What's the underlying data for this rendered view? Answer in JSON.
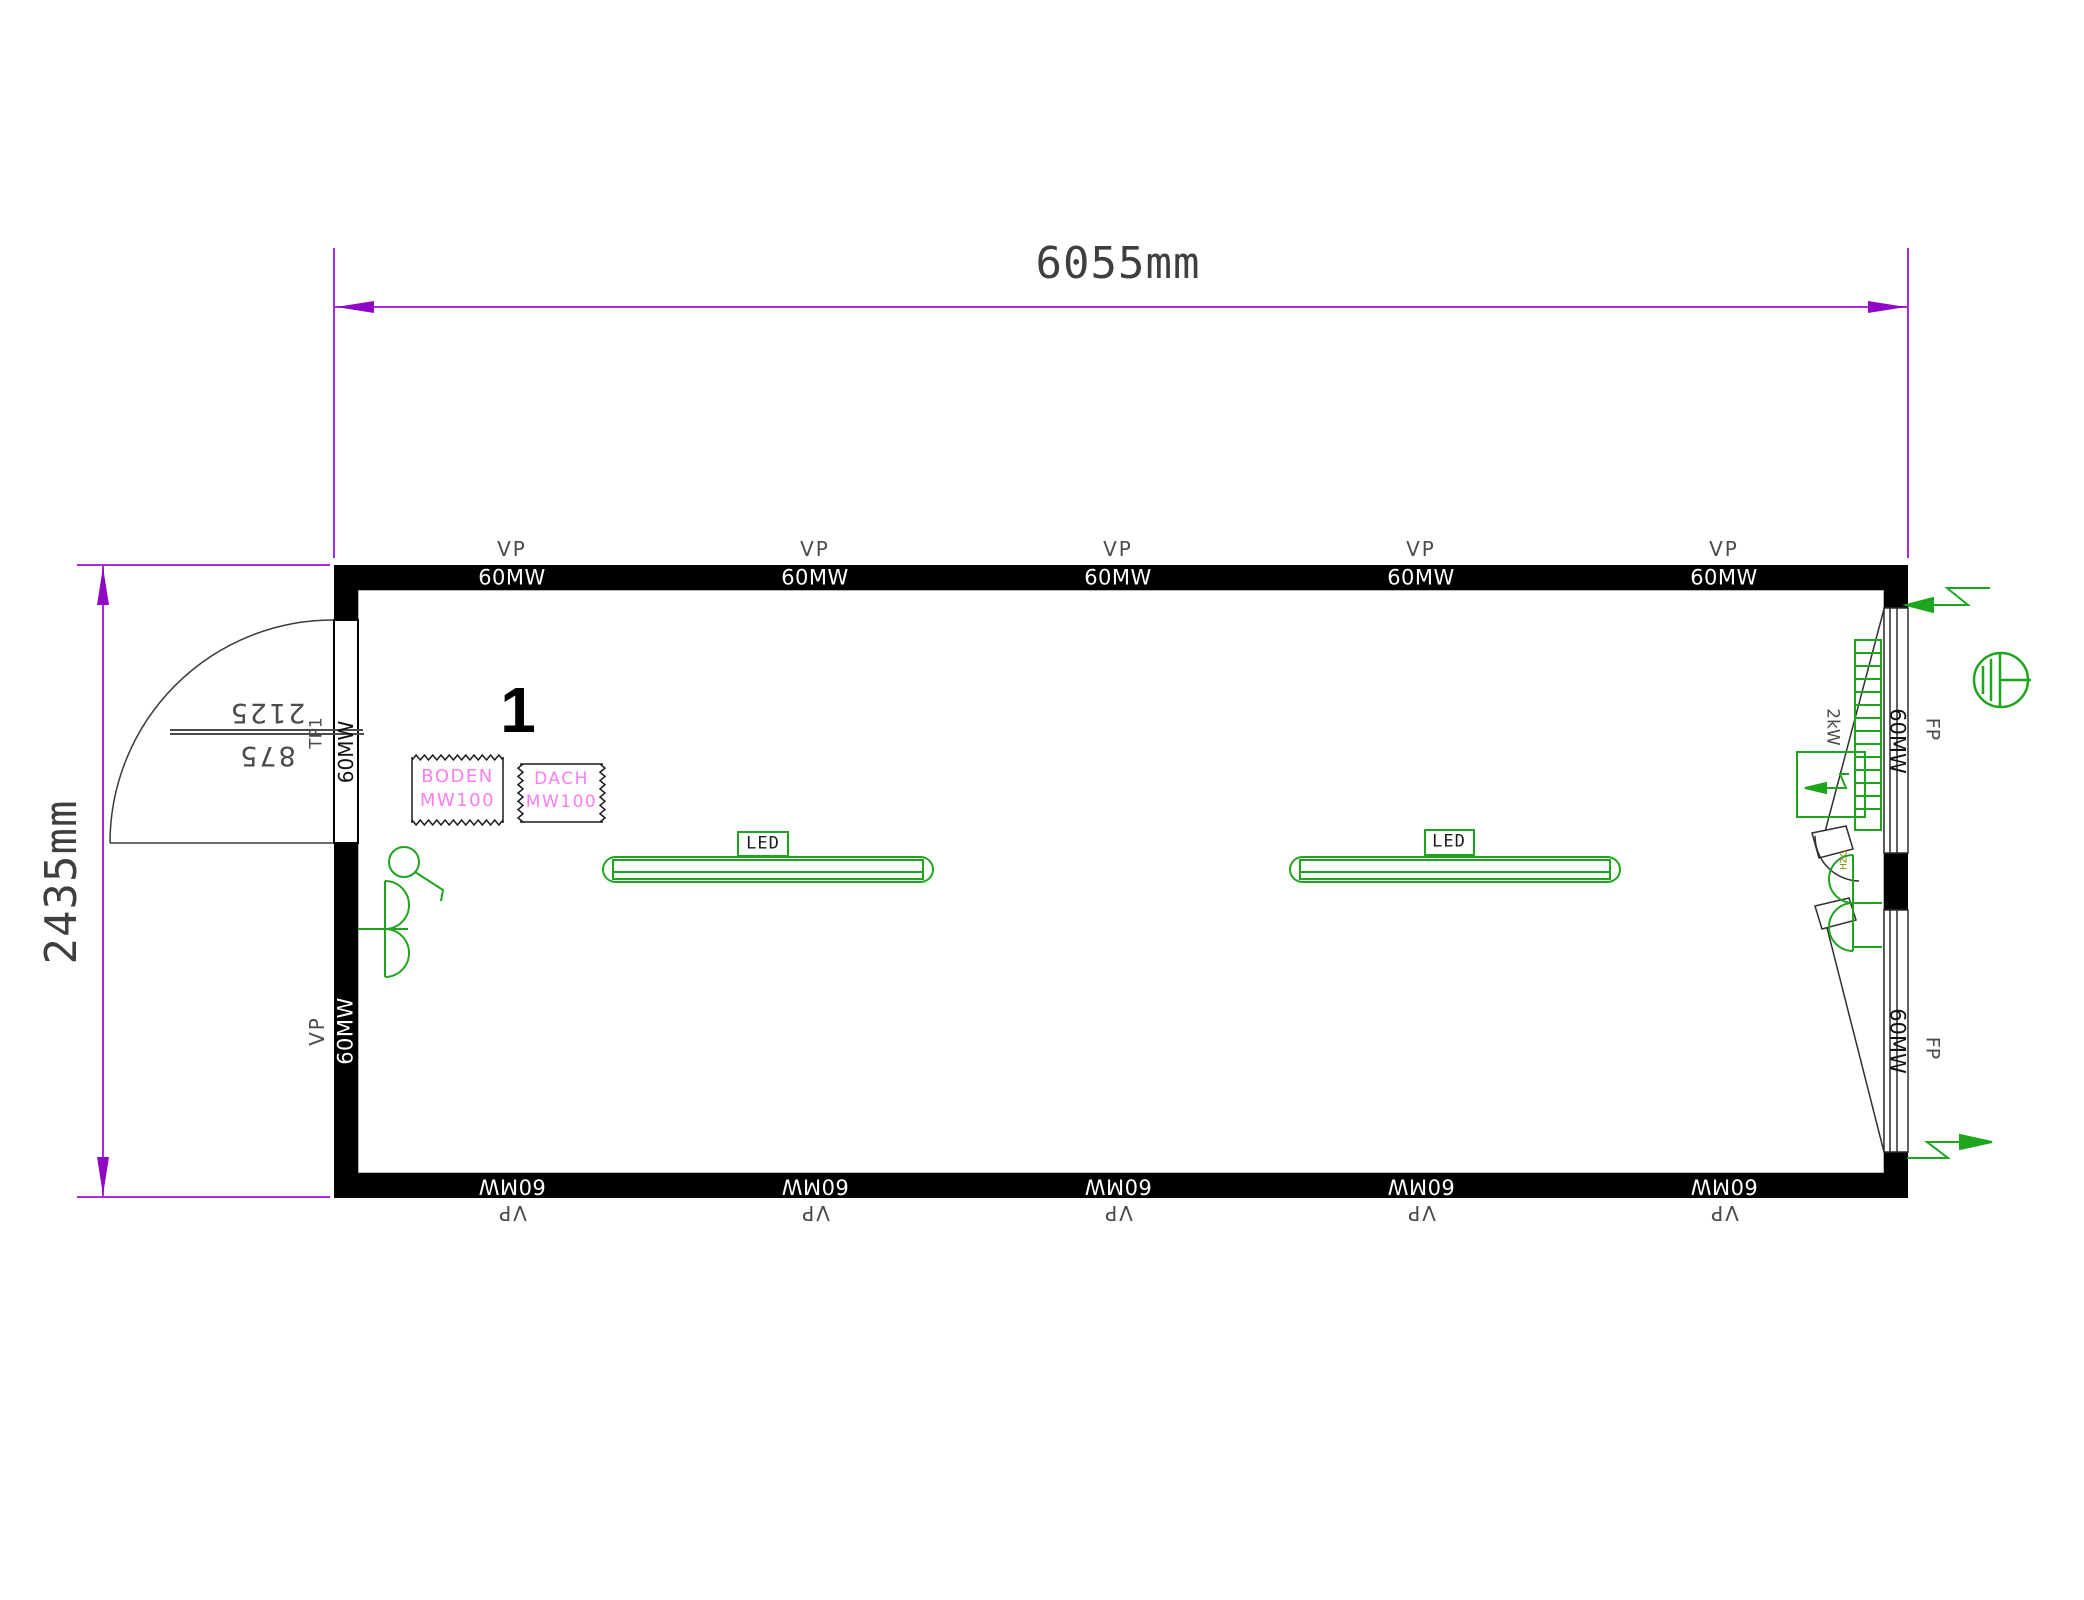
{
  "dimensions": {
    "width_label": "6055mm",
    "height_label": "2435mm"
  },
  "walls": {
    "vp_label": "VP",
    "panel_label": "60MW"
  },
  "door": {
    "width": "875",
    "height": "2125",
    "tag": "TP1",
    "panel_label": "60MW"
  },
  "room": {
    "number": "1"
  },
  "materials": {
    "floor": {
      "line1": "BODEN",
      "line2": "MW100"
    },
    "roof": {
      "line1": "DACH",
      "line2": "MW100"
    }
  },
  "lighting": {
    "label": "LED"
  },
  "heater": {
    "power": "2kW",
    "tag": "HZG"
  },
  "windows": {
    "panel_label": "60MW",
    "fp_label": "FP"
  },
  "colors": {
    "dimension_magenta": "#a92ae2",
    "arrow_magenta": "#8e08c6",
    "drawing_green": "#1ea51e",
    "material_pink": "#fb7df0",
    "wall_black": "#000000",
    "annotation_gray": "#4b4b4b"
  }
}
